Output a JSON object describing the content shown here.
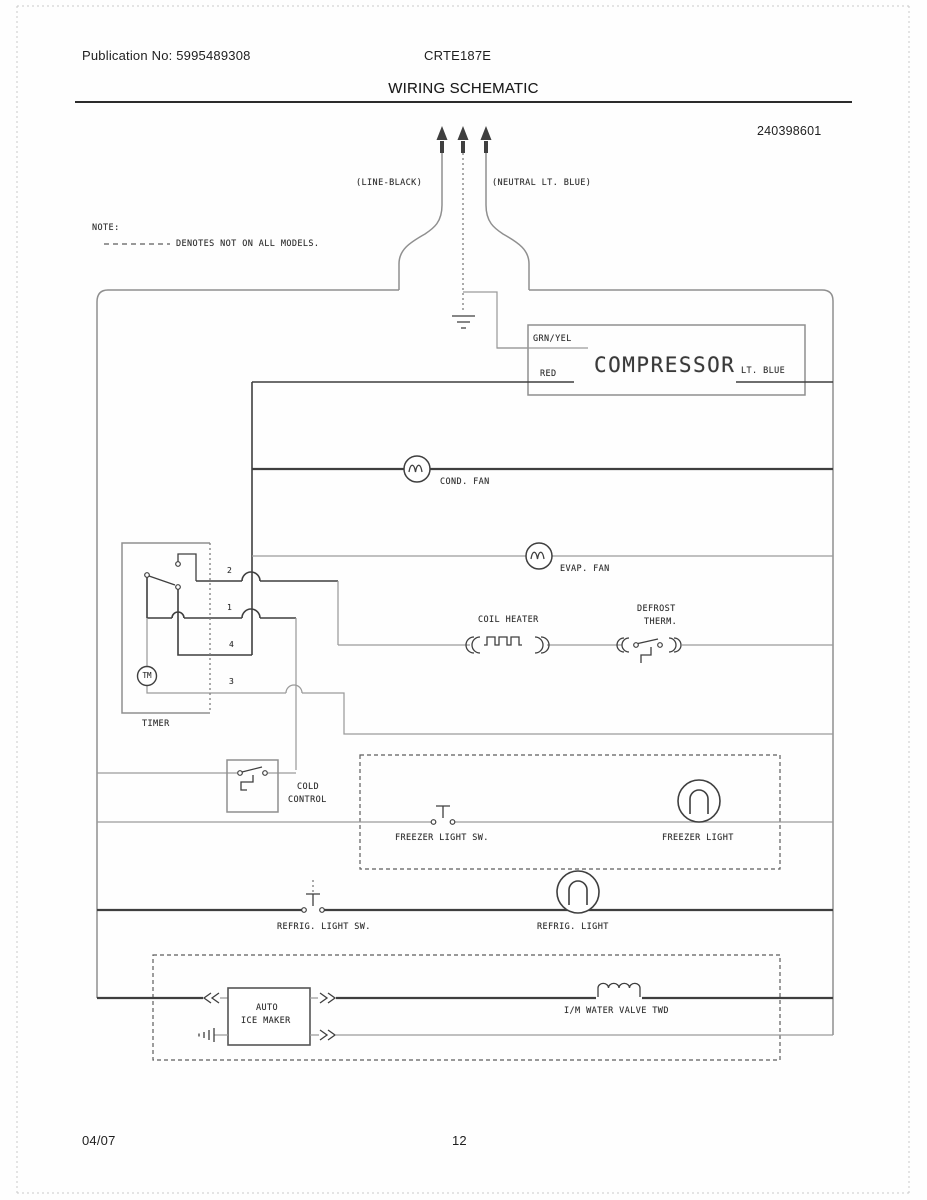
{
  "header": {
    "publication": "Publication No: 5995489308",
    "model": "CRTE187E",
    "title": "WIRING SCHEMATIC",
    "part_number": "240398601"
  },
  "note": {
    "heading": "NOTE:",
    "text": "DENOTES NOT ON ALL MODELS."
  },
  "plug": {
    "line_label": "(LINE-BLACK)",
    "neutral_label": "(NEUTRAL LT. BLUE)"
  },
  "schematic": {
    "compressor": {
      "label": "COMPRESSOR",
      "terminal_top": "GRN/YEL",
      "terminal_left": "RED",
      "terminal_right": "LT. BLUE"
    },
    "cond_fan_label": "COND. FAN",
    "evap_fan_label": "EVAP. FAN",
    "coil_heater_label": "COIL HEATER",
    "defrost_therm_label_1": "DEFROST",
    "defrost_therm_label_2": "THERM.",
    "timer": {
      "label": "TIMER",
      "motor_label": "TM",
      "terminals": [
        "2",
        "1",
        "4",
        "3"
      ]
    },
    "cold_control_label_1": "COLD",
    "cold_control_label_2": "CONTROL",
    "freezer_light_switch_label": "FREEZER LIGHT SW.",
    "freezer_light_label": "FREEZER LIGHT",
    "refrig_light_switch_label": "REFRIG. LIGHT SW.",
    "refrig_light_label": "REFRIG. LIGHT",
    "ice_maker_label_1": "AUTO",
    "ice_maker_label_2": "ICE MAKER",
    "water_valve_label": "I/M WATER VALVE TWD"
  },
  "footer": {
    "date": "04/07",
    "page": "12"
  },
  "colors": {
    "wire_dark": "#3f3f3f",
    "wire_gray": "#9a9a9a",
    "box_gray": "#8f8f8f",
    "text": "#2f2f2f"
  }
}
